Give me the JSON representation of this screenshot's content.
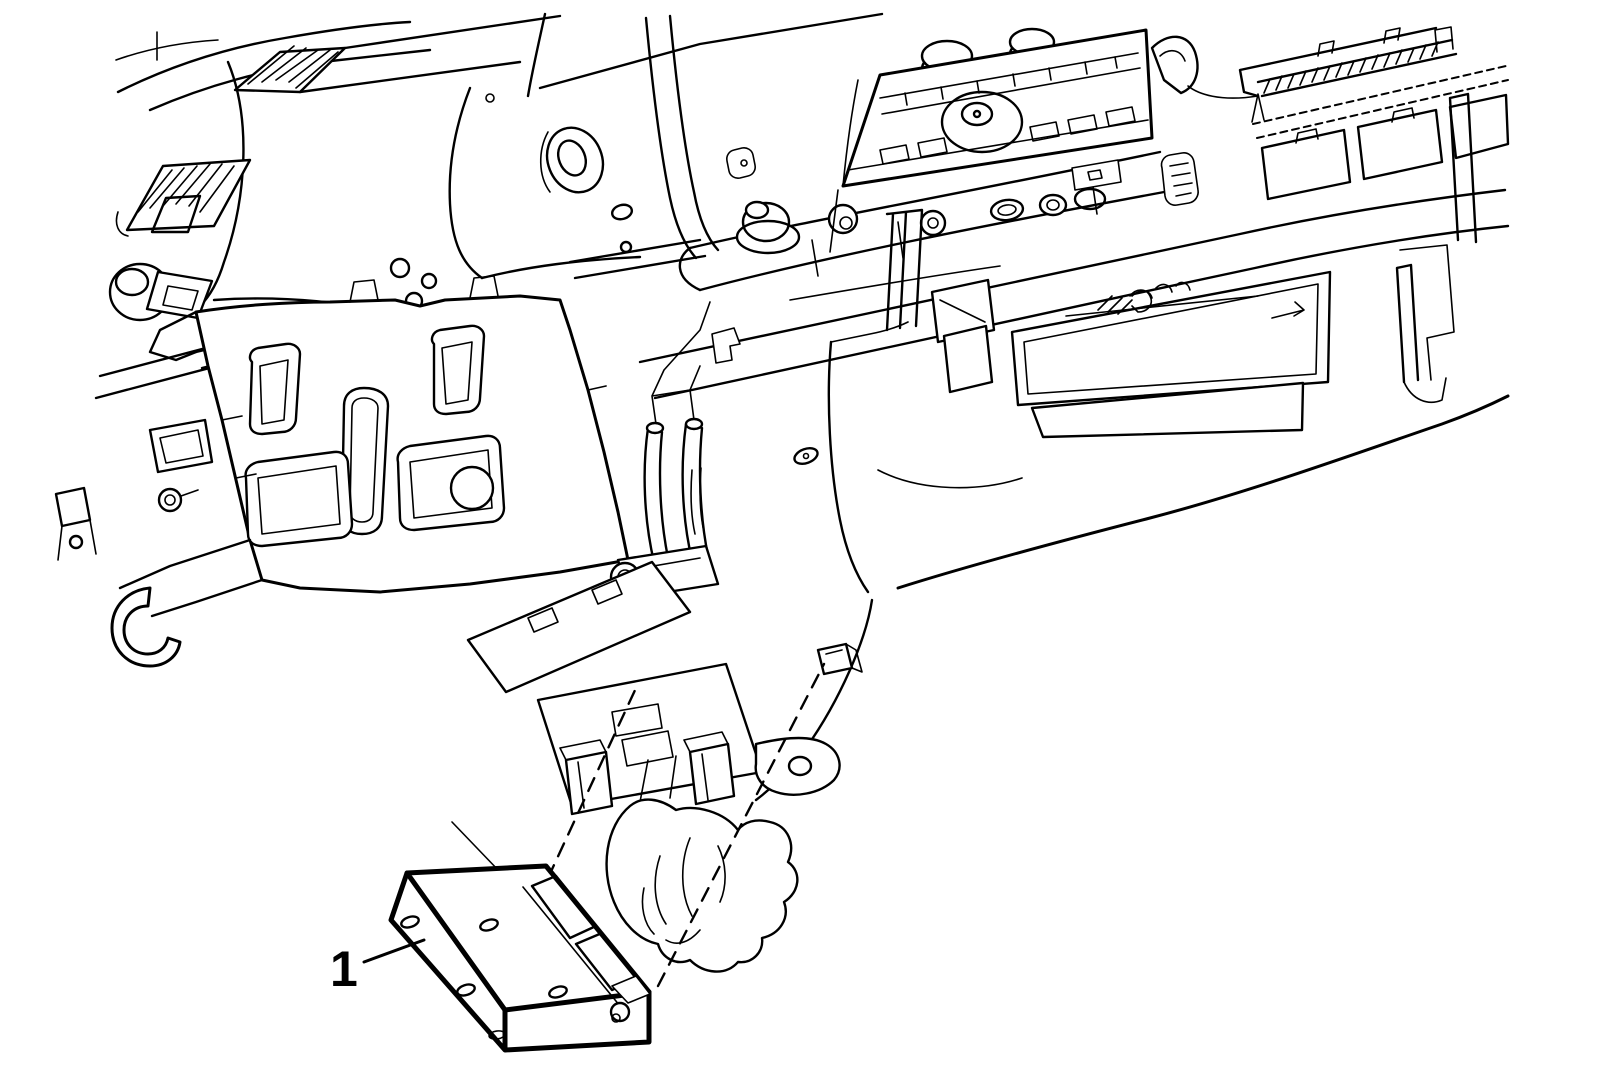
{
  "figure": {
    "type": "technical-line-illustration",
    "subject": "Instrument panel assembly shown from below with electronic control module removed",
    "callout": {
      "label": "1",
      "points_to": "control-module"
    },
    "style": {
      "background": "#ffffff",
      "line_color": "#000000"
    },
    "parts": [
      "instrument-cluster-hood",
      "left-air-vent",
      "headlamp-switch",
      "radio-head-unit",
      "radio-knob",
      "hvac-control-bar",
      "defroster-grille",
      "glovebox-opening",
      "ip-carrier-bracket",
      "steering-column-mount",
      "module-mounting-bracket",
      "steering-column-boot",
      "control-module"
    ]
  }
}
